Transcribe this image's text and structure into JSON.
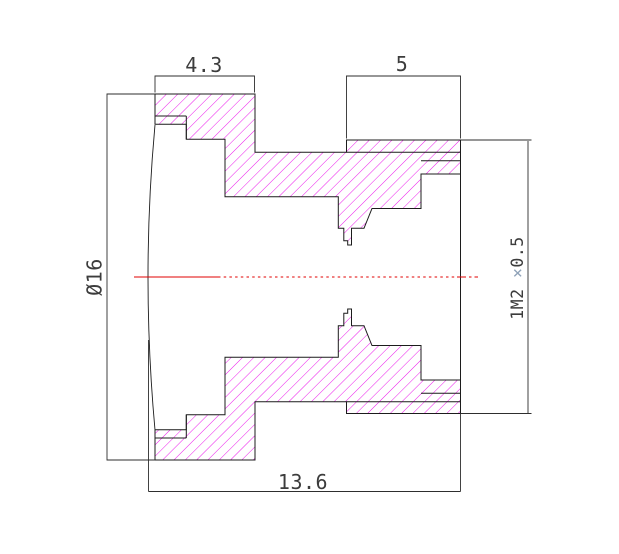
{
  "drawing": {
    "kind": "lens-barrel-cross-section",
    "dimensions": {
      "flange_width": {
        "label": "4.3"
      },
      "thread_length": {
        "label": "5"
      },
      "total_length": {
        "label": "13.6"
      },
      "outer_diameter": {
        "label": "Ø16"
      },
      "thread_spec": {
        "label": "1M2 ×0.5",
        "prefix": "1M2 ",
        "times": "×",
        "suffix": "0.5"
      }
    }
  },
  "colors": {
    "outline": "#1c1c1c",
    "hatch": "#ea00ea",
    "centerline": "#e10000",
    "dimension": "#2e2e2e",
    "text": "#3c3c3c",
    "times_sign": "#8fa2b8",
    "background": "#ffffff"
  }
}
